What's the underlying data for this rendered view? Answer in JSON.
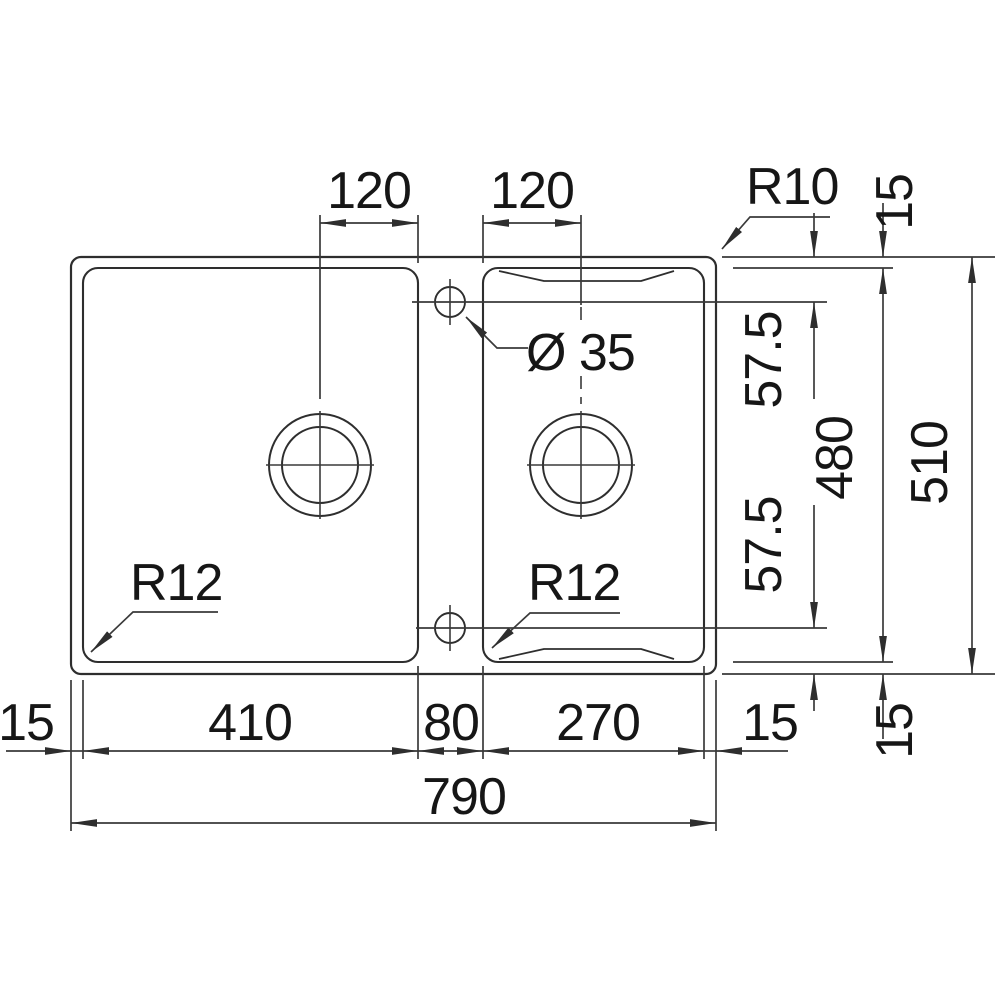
{
  "sink_drawing": {
    "description": "Technical top-view dimension drawing of a 1.5-bowl inset kitchen sink",
    "labels": {
      "dim_120_left": "120",
      "dim_120_right": "120",
      "radius_outer": "R10",
      "dim_15_top": "15",
      "hole_diameter": "Ø 35",
      "dim_57_5_top": "57.5",
      "dim_57_5_bottom": "57.5",
      "dim_480": "480",
      "dim_510": "510",
      "dim_15_left": "15",
      "dim_410": "410",
      "dim_80": "80",
      "dim_270": "270",
      "dim_15_right": "15",
      "dim_15_bottom_right": "15",
      "dim_790": "790",
      "radius_bowl_left": "R12",
      "radius_bowl_right": "R12"
    },
    "dimensions_mm": {
      "overall_width": 790,
      "overall_depth": 510,
      "main_bowl_width": 410,
      "half_bowl_width": 270,
      "bowl_depth": 480,
      "divider_width": 80,
      "edge_margin": 15,
      "drain_offset_from_edge": 120,
      "tap_hole_offset": 57.5,
      "tap_hole_diameter": 35,
      "outer_corner_radius": "R10",
      "bowl_corner_radius": "R12"
    },
    "colors": {
      "line": "#2e2e2e",
      "dimension_line": "#3a3a3a",
      "text": "#161616",
      "background": "#ffffff"
    }
  }
}
